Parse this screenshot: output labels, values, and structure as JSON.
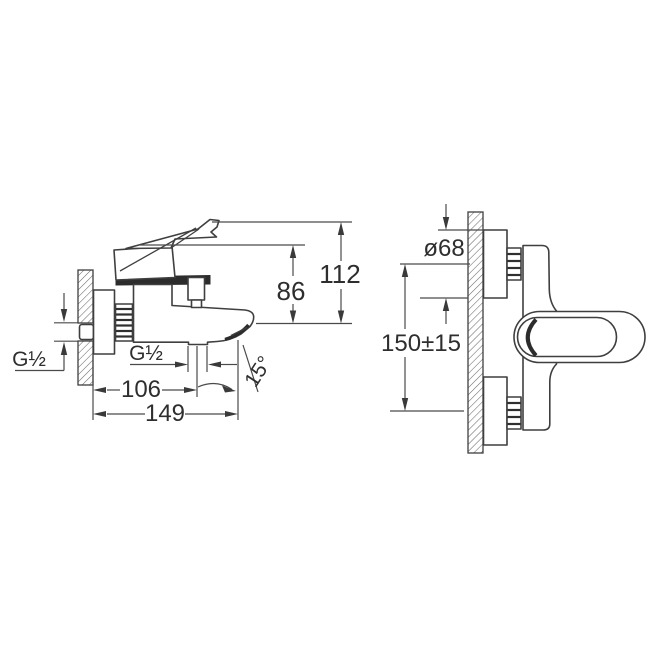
{
  "drawing": {
    "kind": "bath-mixer-faucet installation dimension drawing",
    "colors": {
      "background": "#ffffff",
      "line": "#3f3f3f",
      "dimension_line": "#4a4a4a",
      "text": "#2e2e2e",
      "hatch": "#6a6a6a",
      "dark_detail": "#2c2c2c"
    }
  },
  "side_view": {
    "wall_thread_label": "G½",
    "outlet_thread_label": "G½",
    "dim_outlet_depth": "106",
    "dim_total_depth": "149",
    "dim_height_body": "86",
    "dim_height_lever": "112",
    "dim_spout_angle": "15°"
  },
  "front_view": {
    "dim_escutcheon_diameter": "ø68",
    "dim_connection_centers": "150±15"
  }
}
